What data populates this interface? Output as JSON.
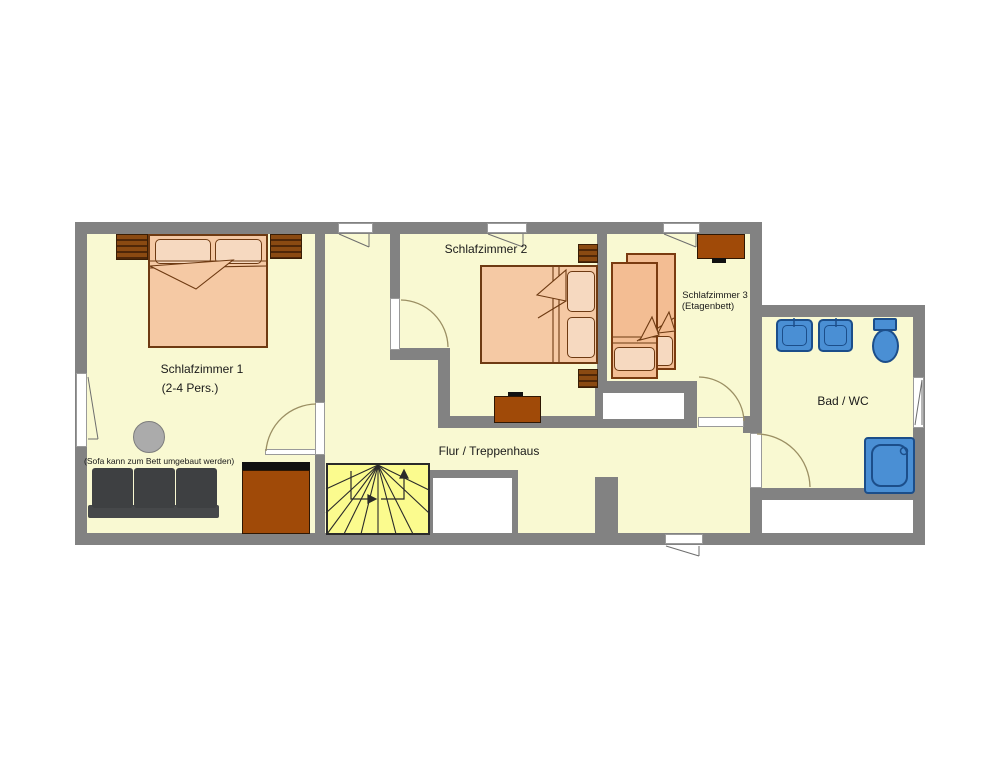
{
  "plan": {
    "type": "apartment-floor-plan",
    "rooms": {
      "schlafzimmer1": {
        "label": "Schlafzimmer 1",
        "capacity": "(2-4 Pers.)",
        "note": "(Sofa kann zum Bett umgebaut werden)",
        "furniture": [
          "double-bed",
          "nightstand",
          "nightstand",
          "round-side-table",
          "sofa-bed",
          "wardrobe"
        ]
      },
      "schlafzimmer2": {
        "label": "Schlafzimmer 2",
        "furniture": [
          "double-bed",
          "nightstand",
          "nightstand",
          "dresser"
        ]
      },
      "schlafzimmer3": {
        "label": "Schlafzimmer 3",
        "bed_type": "(Etagenbett)",
        "furniture": [
          "bunk-bed-upper",
          "bunk-bed-lower",
          "dresser"
        ]
      },
      "bad_wc": {
        "label": "Bad / WC",
        "furniture": [
          "sink",
          "sink",
          "toilet",
          "shower"
        ]
      },
      "flur": {
        "label": "Flur / Treppenhaus",
        "furniture": [
          "winder-staircase"
        ]
      }
    },
    "colors": {
      "floor": "#F9F9D2",
      "wall": "#828282",
      "stairs": "#FBFB8E",
      "bed_fill": "#F5C9A4",
      "bed_border": "#6E3A12",
      "furniture_brown": "#A04A08",
      "sofa_gray": "#3E4042",
      "fixture_blue": "#4A8FD4",
      "fixture_border": "#1C4E8A"
    }
  }
}
